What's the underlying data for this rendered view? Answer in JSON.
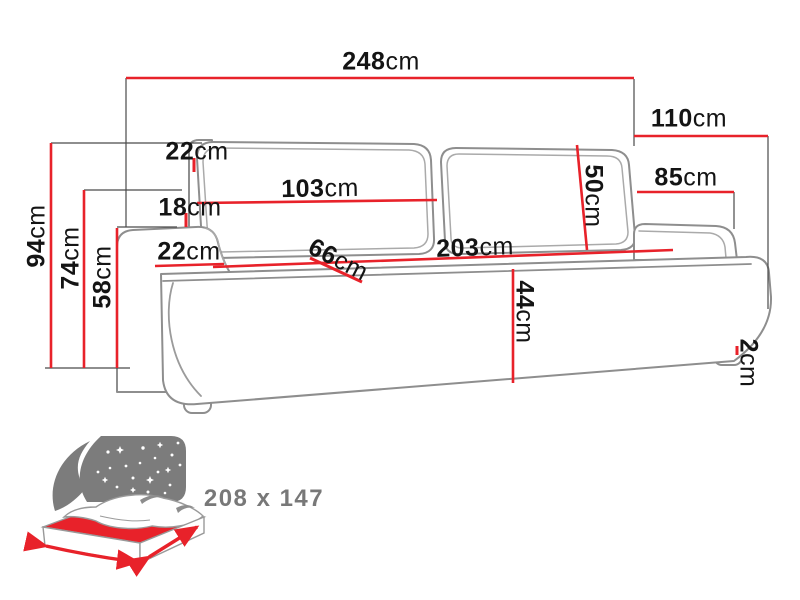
{
  "diagram": {
    "title_semantic": "sofa-dimension-diagram",
    "dimensions": {
      "total_width": {
        "value": "248",
        "unit": "cm"
      },
      "total_depth": {
        "value": "110",
        "unit": "cm"
      },
      "armrest_depth": {
        "value": "85",
        "unit": "cm"
      },
      "total_height": {
        "value": "94",
        "unit": "cm"
      },
      "backrest_height": {
        "value": "74",
        "unit": "cm"
      },
      "armrest_height": {
        "value": "58",
        "unit": "cm"
      },
      "cushion_top_gap": {
        "value": "22",
        "unit": "cm"
      },
      "back_gap": {
        "value": "18",
        "unit": "cm"
      },
      "cushion_width": {
        "value": "103",
        "unit": "cm"
      },
      "cushion_height": {
        "value": "50",
        "unit": "cm"
      },
      "armrest_width": {
        "value": "22",
        "unit": "cm"
      },
      "seat_depth": {
        "value": "66",
        "unit": "cm"
      },
      "seat_width": {
        "value": "203",
        "unit": "cm"
      },
      "seat_height": {
        "value": "44",
        "unit": "cm"
      },
      "foot_height": {
        "value": "2",
        "unit": "cm"
      }
    },
    "bed_icon": {
      "sleeping_area": "208 x 147"
    },
    "colors": {
      "dimension_line": "#e8222a",
      "sofa_outline": "#8e8e8e",
      "icon_gray": "#7c7c7c",
      "label_text": "#141414"
    }
  }
}
